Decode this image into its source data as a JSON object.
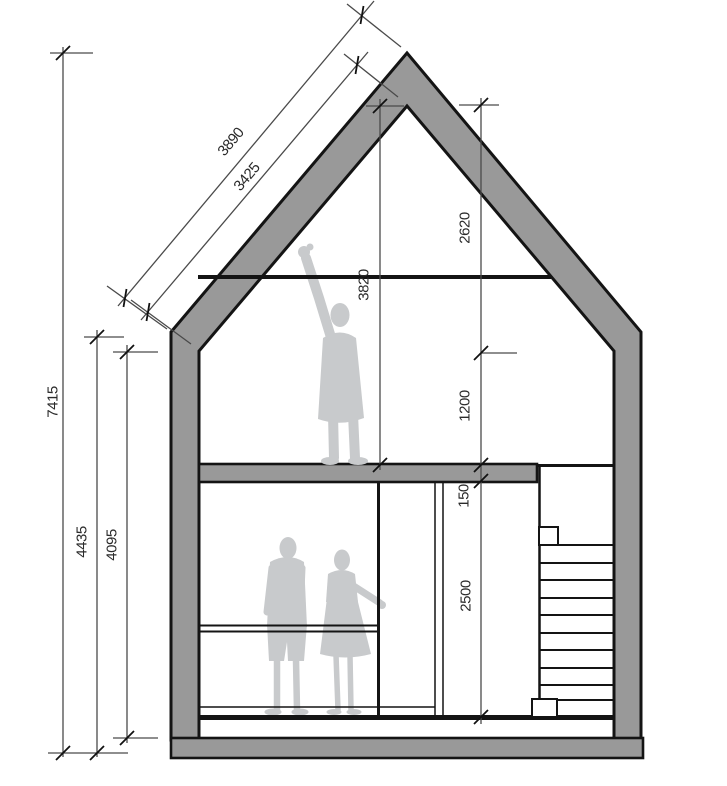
{
  "drawing": {
    "type": "house-cross-section",
    "description": "architectural section of a gabled two-storey house with staircase and human figures",
    "colors": {
      "background": "#ffffff",
      "structure_gray": "#999999",
      "outline_black": "#141414",
      "figure_gray": "#c8cacc",
      "dimension_line": "#4a4a4a",
      "dimension_text": "#2b2b2b"
    },
    "dimension_labels": {
      "overall_height": "7415",
      "wall_height_outer": "4435",
      "wall_height_inner": "4095",
      "roof_slope_outer": "3890",
      "roof_slope_inner": "3425",
      "ridge_to_upper_floor": "3820",
      "ridge_to_kneewall": "2620",
      "kneewall_to_floor": "1200",
      "floor_slab_thickness": "150",
      "ground_floor_height": "2500"
    }
  }
}
